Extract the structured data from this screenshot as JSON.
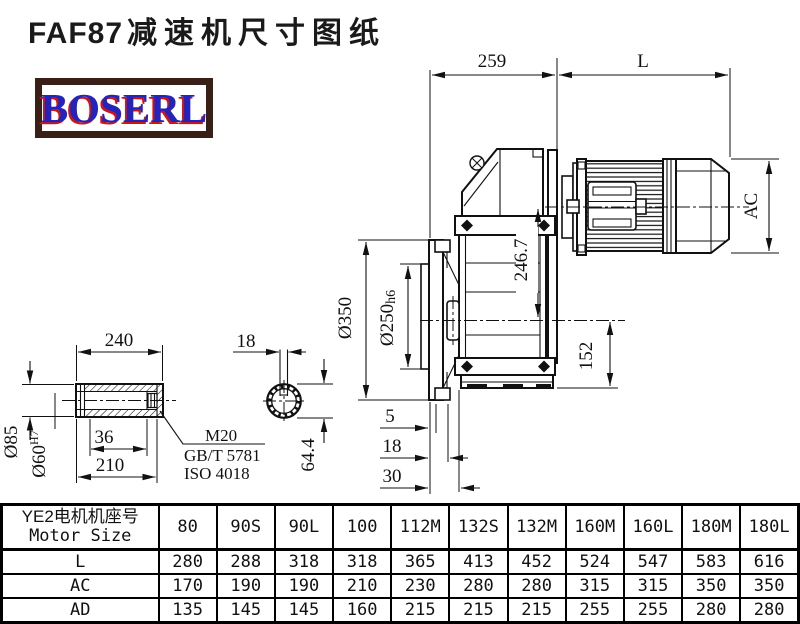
{
  "title": {
    "model": "FAF87",
    "suffix": "减速机尺寸图纸"
  },
  "logo": {
    "text": "BOSERL"
  },
  "drawing": {
    "dims": {
      "d259": "259",
      "L": "L",
      "AC": "AC",
      "d350": "Ø350",
      "d250": "Ø250",
      "d250_fit": "h6",
      "d246": "246.7",
      "d152": "152",
      "off5": "5",
      "off18": "18",
      "off30": "30",
      "len240": "240",
      "d85": "Ø85",
      "d60": "Ø60",
      "d60_fit": "H7",
      "len36": "36",
      "len210": "210",
      "key18": "18",
      "d644": "64.4"
    },
    "notes": {
      "thread": "M20",
      "standard_gb": "GB/T 5781",
      "standard_iso": "ISO 4018"
    }
  },
  "table": {
    "header_cn": "YE2电机机座号",
    "header_en": "Motor Size",
    "columns": [
      "80",
      "90S",
      "90L",
      "100",
      "112M",
      "132S",
      "132M",
      "160M",
      "160L",
      "180M",
      "180L"
    ],
    "rows": [
      {
        "label": "L",
        "values": [
          "280",
          "288",
          "318",
          "318",
          "365",
          "413",
          "452",
          "524",
          "547",
          "583",
          "616"
        ]
      },
      {
        "label": "AC",
        "values": [
          "170",
          "190",
          "190",
          "210",
          "230",
          "280",
          "280",
          "315",
          "315",
          "350",
          "350"
        ]
      },
      {
        "label": "AD",
        "values": [
          "135",
          "145",
          "145",
          "160",
          "215",
          "215",
          "215",
          "255",
          "255",
          "280",
          "280"
        ]
      }
    ]
  }
}
